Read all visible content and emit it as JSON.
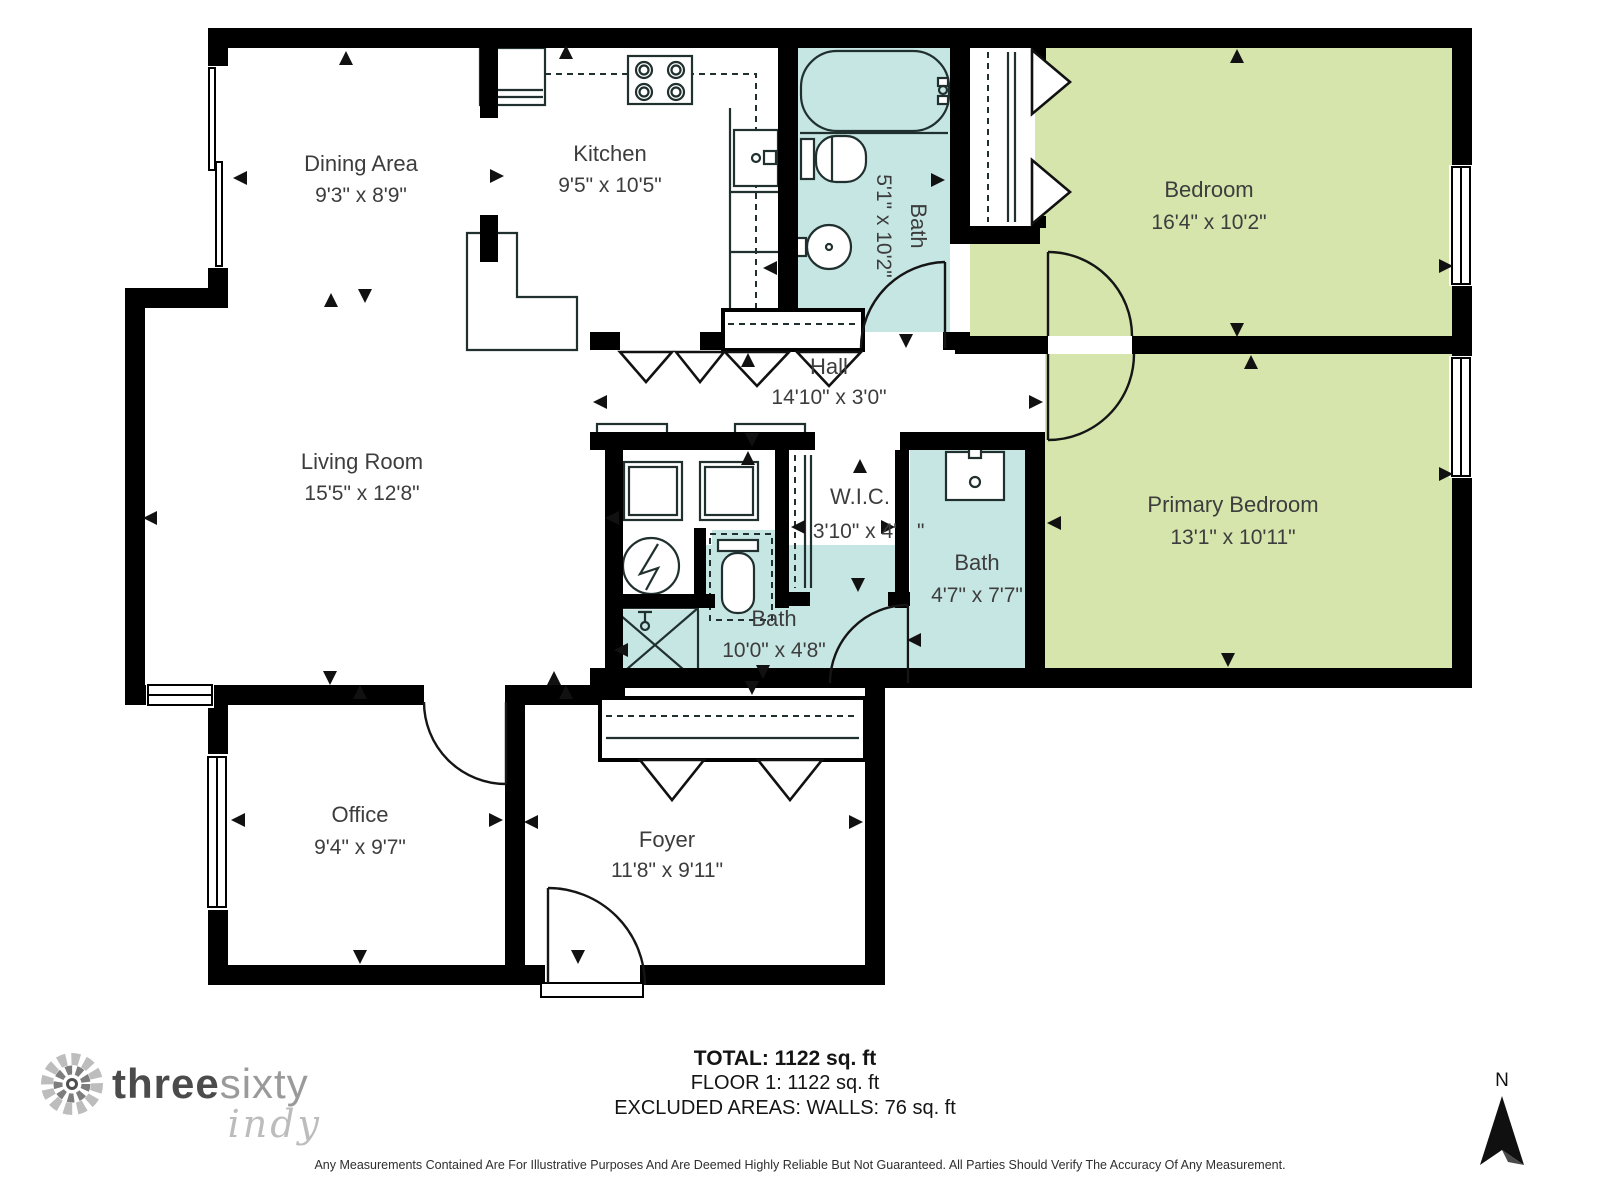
{
  "rooms": [
    {
      "id": "dining",
      "name": "Dining Area",
      "dims": "9'3\" x 8'9\""
    },
    {
      "id": "kitchen",
      "name": "Kitchen",
      "dims": "9'5\" x 10'5\""
    },
    {
      "id": "bath-top",
      "name": "Bath",
      "dims": "5'1\" x 10'2\""
    },
    {
      "id": "bedroom",
      "name": "Bedroom",
      "dims": "16'4\" x 10'2\""
    },
    {
      "id": "hall",
      "name": "Hall",
      "dims": "14'10\" x 3'0\""
    },
    {
      "id": "living",
      "name": "Living Room",
      "dims": "15'5\" x 12'8\""
    },
    {
      "id": "wic",
      "name": "W.I.C.",
      "dims": "3'10\" x 4'",
      "dims_suffix": "\""
    },
    {
      "id": "bath-mid",
      "name": "Bath",
      "dims": "4'7\" x 7'7\""
    },
    {
      "id": "primary",
      "name": "Primary Bedroom",
      "dims": "13'1\" x 10'11\""
    },
    {
      "id": "bath-low",
      "name": "Bath",
      "dims": "10'0\" x 4'8\""
    },
    {
      "id": "office",
      "name": "Office",
      "dims": "9'4\" x 9'7\""
    },
    {
      "id": "foyer",
      "name": "Foyer",
      "dims": "11'8\" x 9'11\""
    }
  ],
  "summary": {
    "total": "TOTAL: 1122 sq. ft",
    "floor": "FLOOR 1: 1122 sq. ft",
    "excluded": "EXCLUDED AREAS: WALLS: 76 sq. ft"
  },
  "disclaimer": "Any Measurements Contained Are For Illustrative Purposes And Are Deemed Highly Reliable But Not Guaranteed. All Parties Should Verify The Accuracy Of Any Measurement.",
  "logo": {
    "part1": "three",
    "part2": "sixty",
    "part3": "indy"
  },
  "compass": {
    "label": "N"
  },
  "colors": {
    "room_green": "#d5e5ab",
    "room_teal": "#c6e6e4",
    "wall": "#000000",
    "label_text": "#3d3d3d"
  }
}
